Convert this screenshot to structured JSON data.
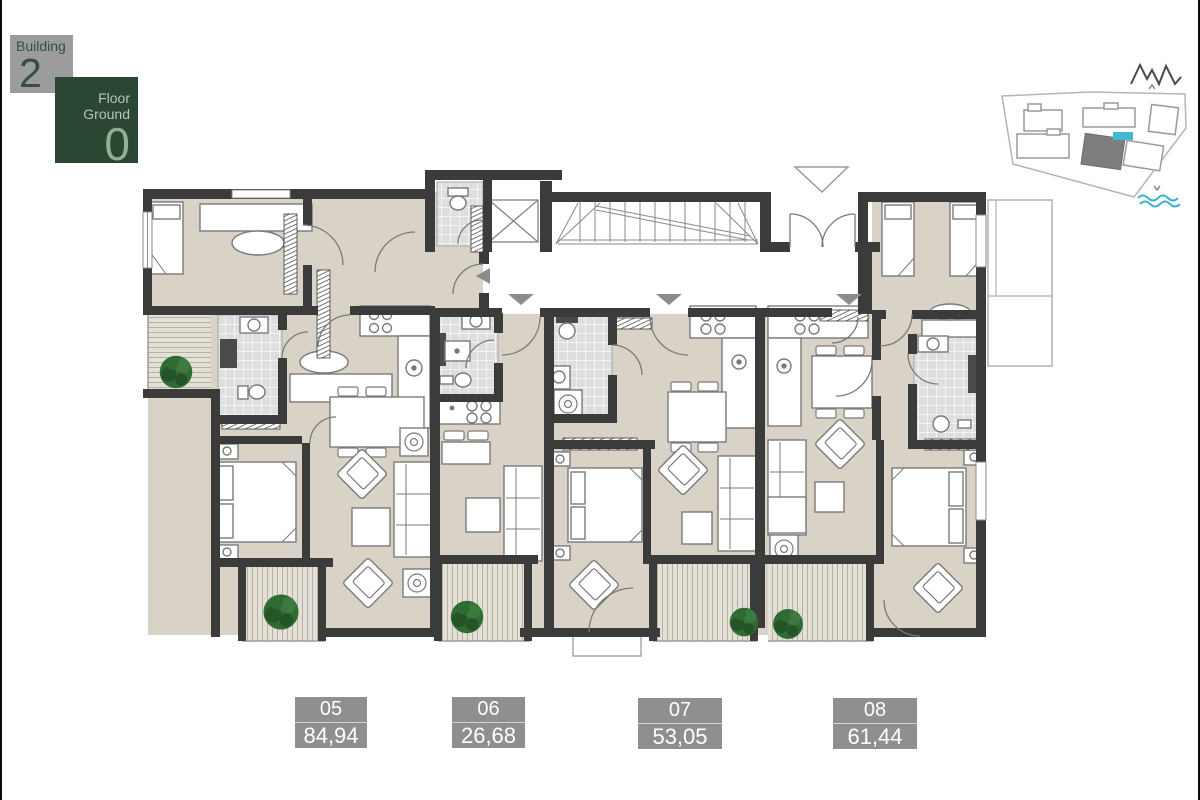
{
  "app": {
    "background": "#ffffff"
  },
  "building_badge": {
    "label": "Building",
    "number": "2",
    "bg": "#9c9c9c"
  },
  "floor_badge": {
    "line1": "Floor",
    "line2": "Ground",
    "number": "0",
    "bg": "#294733"
  },
  "site_map": {
    "selected_building": "Building 2",
    "selected_fill": "#7d7d7d",
    "pool_color": "#44b7d7",
    "sea_color": "#3bb3d0",
    "mountain_color": "#4a4a4a",
    "outline_color": "#b5b5b5"
  },
  "floor_plan": {
    "wall_color": "#3b3b3b",
    "floor_color": "#d8d3c6",
    "tile_color": "#dedede",
    "deck_color": "#e4e0d5",
    "tree_color": "#2f6b33",
    "arrow_color": "#8c8c8c"
  },
  "units": [
    {
      "number": "05",
      "area": "84,94"
    },
    {
      "number": "06",
      "area": "26,68"
    },
    {
      "number": "07",
      "area": "53,05"
    },
    {
      "number": "08",
      "area": "61,44"
    }
  ],
  "label_style": {
    "bg": "#8f8f8f",
    "text_color": "#ffffff"
  }
}
